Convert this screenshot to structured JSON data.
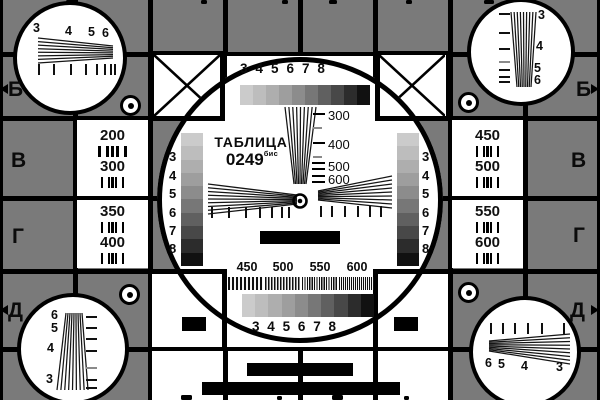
{
  "card": {
    "title": "ТАБЛИЦА",
    "code": "0249",
    "code_suffix": "бис",
    "colors": {
      "background_gray": "#7a7a7a",
      "card_white": "#ffffff",
      "ink_black": "#000000",
      "intermediate_tick_gray": "#8a8a8a"
    },
    "grayscale_steps": [
      "#cbcbcb",
      "#bdbdbd",
      "#aeaeae",
      "#9e9e9e",
      "#8c8c8c",
      "#777777",
      "#606060",
      "#484848",
      "#2c2c2c",
      "#111111"
    ],
    "top_scale_digits": [
      "3",
      "4",
      "5",
      "6",
      "7",
      "8"
    ],
    "bottom_scale_digits": [
      "3",
      "4",
      "5",
      "6",
      "7",
      "8"
    ],
    "center_wedge_marks": [
      "300",
      "400",
      "500",
      "600"
    ],
    "multiburst_marks": [
      "450",
      "500",
      "550",
      "600"
    ],
    "left_strip_digits": [
      "3",
      "4",
      "5",
      "6",
      "7",
      "8"
    ],
    "right_strip_digits": [
      "3",
      "4",
      "5",
      "6",
      "7",
      "8"
    ],
    "left_cells": [
      [
        "200",
        "300"
      ],
      [
        "350",
        "400"
      ]
    ],
    "right_cells": [
      [
        "450",
        "500"
      ],
      [
        "550",
        "600"
      ]
    ],
    "edge_labels_left": [
      "Б",
      "В",
      "Г",
      "Д"
    ],
    "edge_labels_right": [
      "Б",
      "В",
      "Г",
      "Д"
    ],
    "corner_digits": {
      "top_left": [
        "3",
        "4",
        "5",
        "6"
      ],
      "top_right": [
        "3",
        "4",
        "5",
        "6"
      ],
      "bottom_left": [
        "6",
        "5",
        "4",
        "3"
      ],
      "bottom_right": [
        "6",
        "5",
        "4",
        "3"
      ]
    }
  }
}
